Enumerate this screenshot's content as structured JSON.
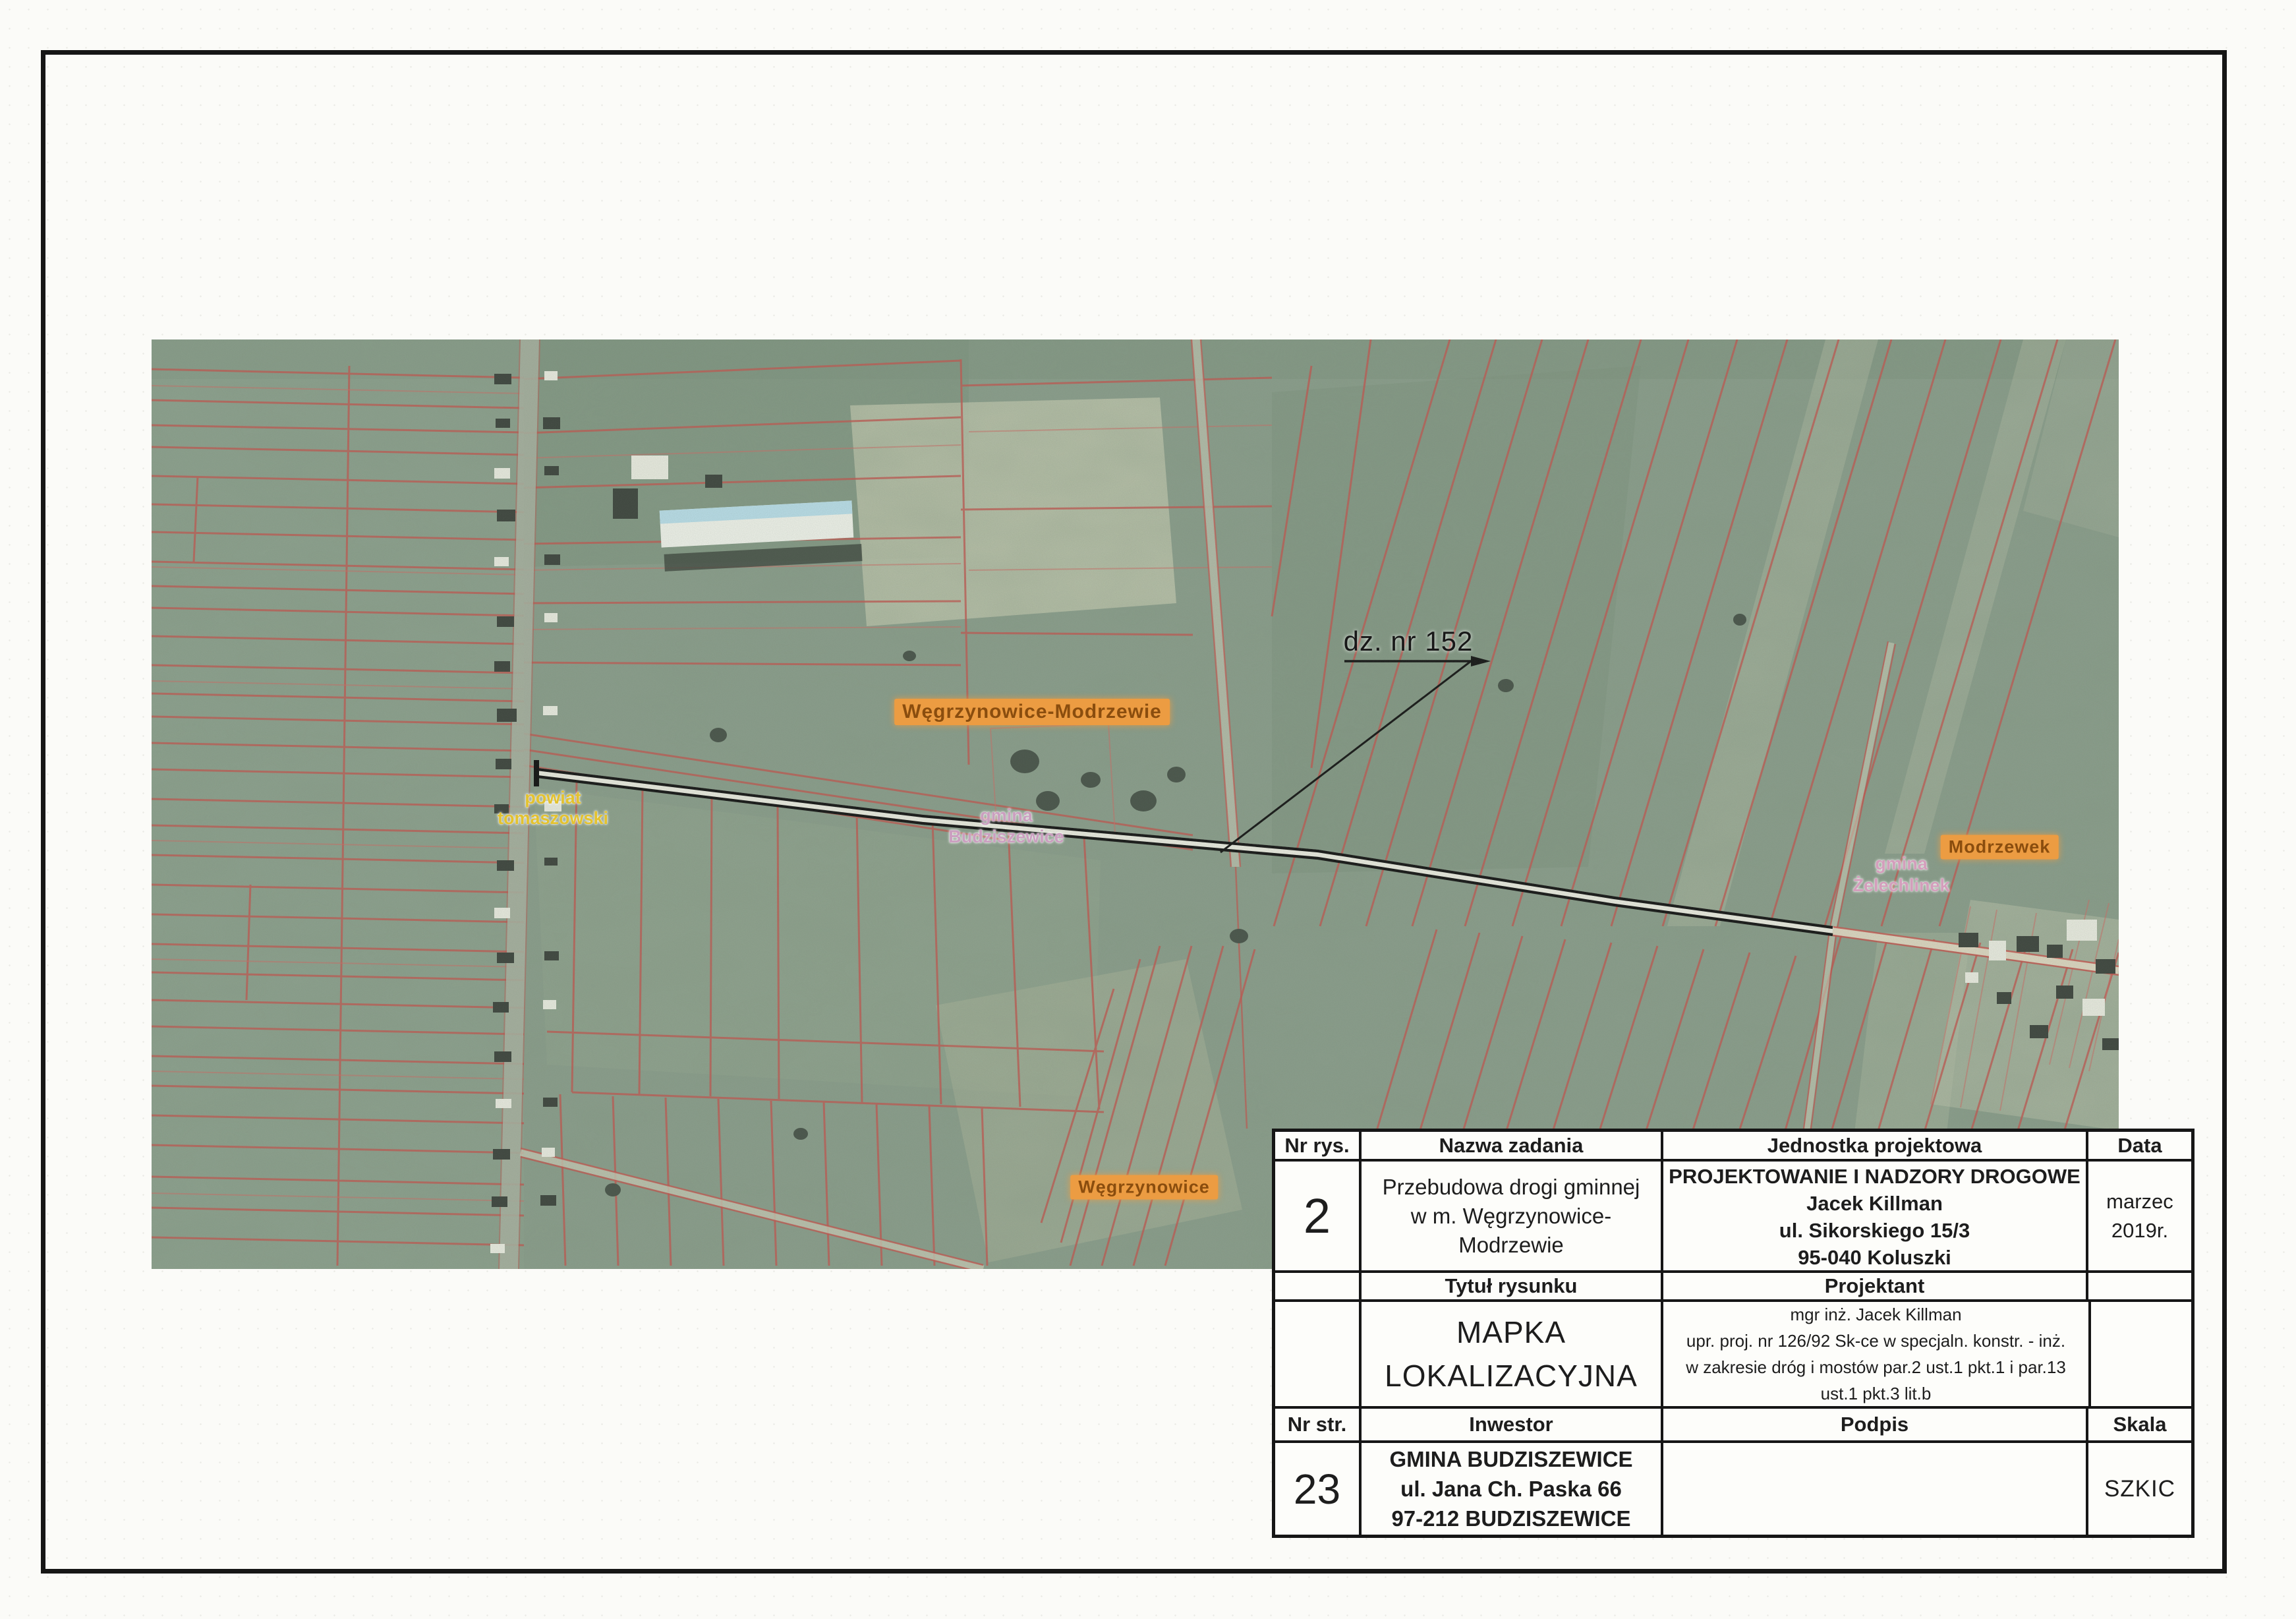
{
  "map": {
    "annotation": {
      "parcel": "dz. nr 152"
    },
    "labels": {
      "village_major": "Węgrzynowice-Modrzewie",
      "gmina_budziszewice": [
        "gmina",
        "Budziszewice"
      ],
      "powiat_tomaszowski": [
        "powiat",
        "tomaszowski"
      ],
      "gmina_zelechlinek": [
        "gmina",
        "Żelechlinek"
      ],
      "village_modrzewek": "Modrzewek",
      "village_wegrzynowice": "Węgrzynowice"
    },
    "colors": {
      "parcel_line_red": "#bf5a52",
      "label_orange_bg": "#ec9c42",
      "label_yellow": "#e3c22f",
      "label_pink": "#cb9fc0",
      "road_black": "#161616",
      "field_green": "#8b9e8c"
    }
  },
  "title_block": {
    "headers": {
      "nr_rys": "Nr rys.",
      "nazwa_zadania": "Nazwa zadania",
      "jednostka_projektowa": "Jednostka projektowa",
      "data": "Data",
      "tytul_rysunku": "Tytuł rysunku",
      "projektant": "Projektant",
      "nr_str": "Nr str.",
      "inwestor": "Inwestor",
      "podpis": "Podpis",
      "skala": "Skala"
    },
    "values": {
      "drawing_number": "2",
      "task_name_lines": [
        "Przebudowa drogi gminnej",
        "w m. Węgrzynowice-",
        "Modrzewie"
      ],
      "design_unit_lines": [
        "PROJEKTOWANIE I NADZORY DROGOWE",
        "Jacek Killman",
        "ul. Sikorskiego 15/3",
        "95-040 Koluszki"
      ],
      "date_lines": [
        "marzec",
        "2019r."
      ],
      "drawing_title_lines": [
        "MAPKA",
        "LOKALIZACYJNA"
      ],
      "designer_lines": [
        "mgr inż. Jacek Killman",
        "upr. proj. nr 126/92 Sk-ce w specjaln. konstr. - inż.",
        "w zakresie dróg i mostów par.2 ust.1 pkt.1 i par.13",
        "ust.1 pkt.3 lit.b"
      ],
      "page_number": "23",
      "investor_lines": [
        "GMINA BUDZISZEWICE",
        "ul. Jana Ch. Paska 66",
        "97-212 BUDZISZEWICE"
      ],
      "signature": "",
      "scale_value": "SZKIC"
    }
  }
}
